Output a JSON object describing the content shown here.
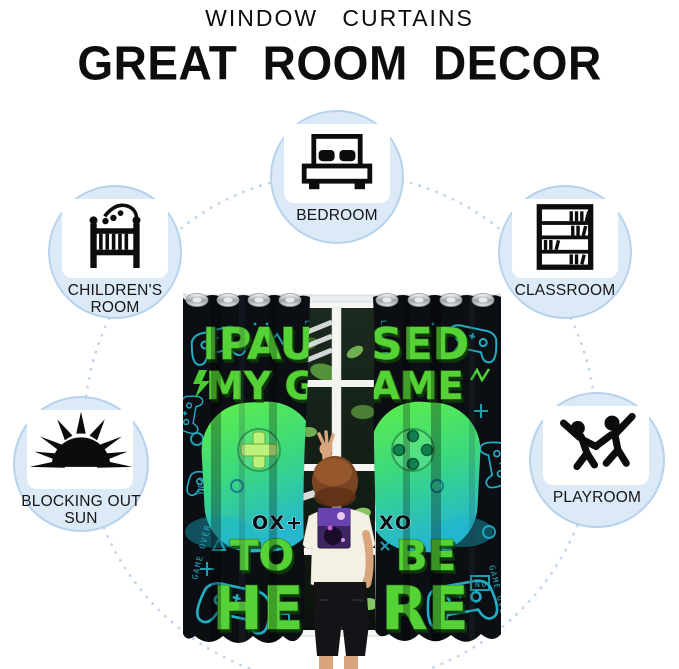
{
  "header": {
    "title": "WINDOW CURTAINS",
    "subtitle": "GREAT ROOM DECOR"
  },
  "badges": [
    {
      "label": "BEDROOM",
      "icon": "bed-icon"
    },
    {
      "label": "CHILDREN'S ROOM",
      "icon": "crib-icon"
    },
    {
      "label": "CLASSROOM",
      "icon": "bookshelf-icon"
    },
    {
      "label": "BLOCKING OUT SUN",
      "icon": "sun-icon"
    },
    {
      "label": "PLAYROOM",
      "icon": "children-playing-icon"
    }
  ],
  "curtain": {
    "slogan_full": "I PAUSED MY GAME TO BE HERE",
    "slogan_left_lines": [
      "IPAU",
      "MY G",
      "TO",
      "HE"
    ],
    "slogan_right_lines": [
      "SED",
      "AME",
      "BE",
      "RE"
    ],
    "symbols_left": "OX+",
    "symbols_right": "XO",
    "pattern_words": [
      "GAME OVER",
      "LOADING",
      "YES",
      "NO",
      "ON"
    ]
  },
  "colors": {
    "badge_fill": "#dce9f7",
    "badge_border": "#b7d2ec",
    "badge_card": "#ffffff",
    "dashed_circle": "#c3d6ec",
    "icon_black": "#0c0c0c",
    "curtain_black": "#0b0e12",
    "doodle_teal": "#23adc4",
    "slogan_green": "#55d336",
    "slogan_outline": "#2c7a14",
    "controller_green": "#5fee48",
    "controller_teal": "#26b7cf"
  }
}
